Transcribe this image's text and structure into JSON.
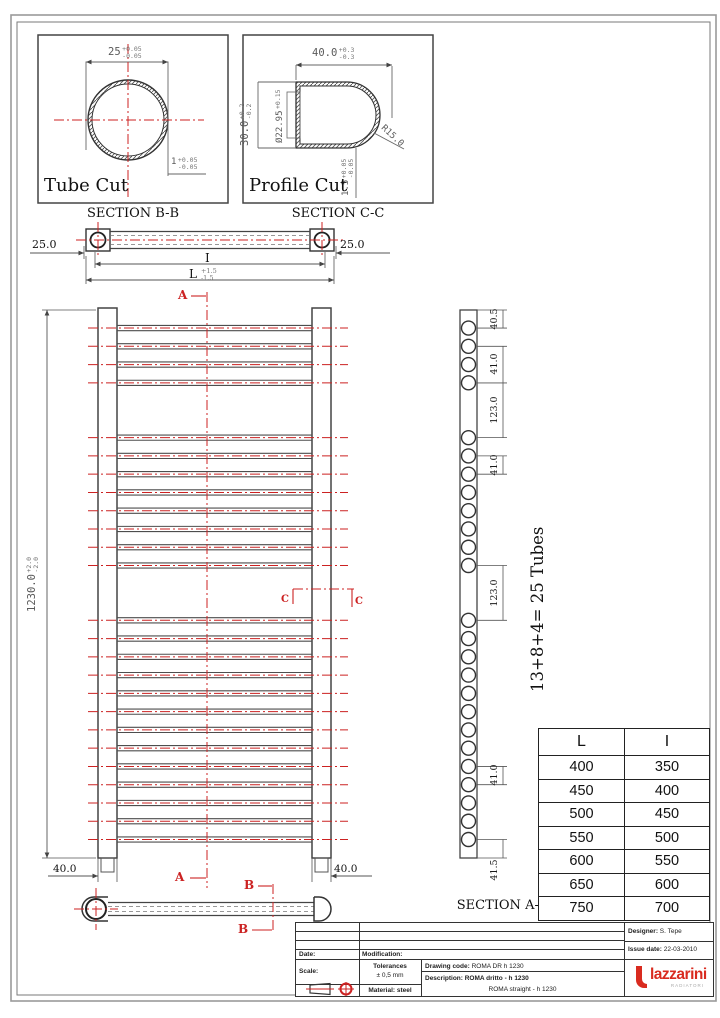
{
  "colors": {
    "red": "#cc2222",
    "line": "#4d4d4d",
    "logo_red": "#d92b1f"
  },
  "tube_cut": {
    "title": "Tube Cut",
    "caption": "SECTION B-B",
    "dia": "25",
    "dia_tol_plus": "+0.05",
    "dia_tol_minus": "-0.05",
    "wall": "1",
    "wall_tol_plus": "+0.05",
    "wall_tol_minus": "-0.05"
  },
  "profile_cut": {
    "title": "Profile Cut",
    "caption": "SECTION C-C",
    "width": "40.0",
    "width_tol_plus": "+0.3",
    "width_tol_minus": "-0.3",
    "height": "30.0",
    "height_tol_plus": "+0.2",
    "height_tol_minus": "-0.2",
    "inner_dia": "Ø22.95",
    "inner_dia_tol": "+0.15",
    "radius": "R15.0",
    "wall": "1.5",
    "wall_tol_plus": "+0.05",
    "wall_tol_minus": "-0.05"
  },
  "top_view": {
    "left_dim": "25.0",
    "right_dim": "25.0",
    "inner_len_label": "I",
    "outer_len_label": "L",
    "len_tol_plus": "+1.5",
    "len_tol_minus": "-1.5"
  },
  "front_view": {
    "height": "1230.0",
    "height_tol_plus": "+2.0",
    "height_tol_minus": "-2.0",
    "collector_dim_left": "40.0",
    "collector_dim_right": "40.0",
    "cut_a": "A",
    "cut_b": "B",
    "cut_c": "C"
  },
  "side_view": {
    "caption": "SECTION A-A",
    "tubes_note": "13+8+4= 25 Tubes",
    "dims": [
      "40.5",
      "41.0",
      "123.0",
      "41.0",
      "123.0",
      "41.0",
      "41.5"
    ]
  },
  "radiator": {
    "groups": [
      4,
      8,
      13
    ],
    "first_offset_mm": 40.5,
    "pitch_mm": 41,
    "gap_mm": 123,
    "total_mm": 1230
  },
  "size_table": {
    "headers": [
      "L",
      "I"
    ],
    "rows": [
      [
        "400",
        "350"
      ],
      [
        "450",
        "400"
      ],
      [
        "500",
        "450"
      ],
      [
        "550",
        "500"
      ],
      [
        "600",
        "550"
      ],
      [
        "650",
        "600"
      ],
      [
        "750",
        "700"
      ]
    ]
  },
  "title_block": {
    "date_label": "Date:",
    "modification_label": "Modification:",
    "scale_label": "Scale:",
    "tolerances_label": "Tolerances",
    "tolerances_value": "± 0,5 mm",
    "material": "Material: steel",
    "drawing_code_label": "Drawing code:",
    "drawing_code": "ROMA DR h 1230",
    "description_label": "Description:",
    "description": "ROMA dritto - h 1230",
    "description_en": "ROMA straight - h 1230",
    "designer_label": "Designer:",
    "designer": "S. Tepe",
    "issue_label": "Issue date:",
    "issue_date": "22-03-2010",
    "brand": "lazzarini",
    "brand_sub": "RADIATORI"
  }
}
